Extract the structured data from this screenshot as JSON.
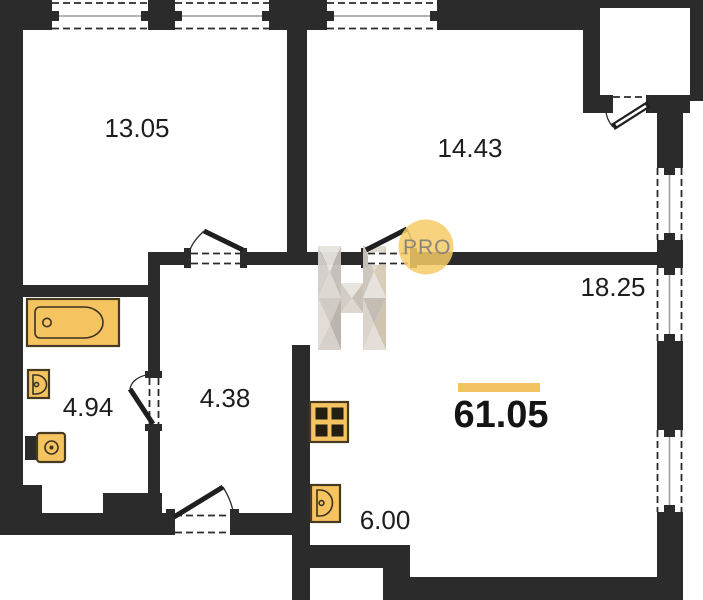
{
  "floor_plan": {
    "rooms": [
      {
        "name": "bedroom-top-left",
        "area": "13.05"
      },
      {
        "name": "bedroom-top-middle",
        "area": "14.43"
      },
      {
        "name": "living-area",
        "area": "18.25"
      },
      {
        "name": "bathroom",
        "area": "4.94"
      },
      {
        "name": "hallway",
        "area": "4.38"
      },
      {
        "name": "kitchen-zone",
        "area": "6.00"
      }
    ],
    "total_area": "61.05",
    "fixtures": [
      "bathtub",
      "washbasin",
      "toilet",
      "stove",
      "kitchen-sink"
    ]
  },
  "watermark": {
    "letter": "H",
    "badge_text": "PRO"
  },
  "colors": {
    "wall": "#2b2b2b",
    "fixture_fill": "#F5C360",
    "accent_bar": "#F2C360",
    "badge_circle": "#F6CB67",
    "badge_text": "#8B8478",
    "label_text": "#1d1d1b"
  }
}
